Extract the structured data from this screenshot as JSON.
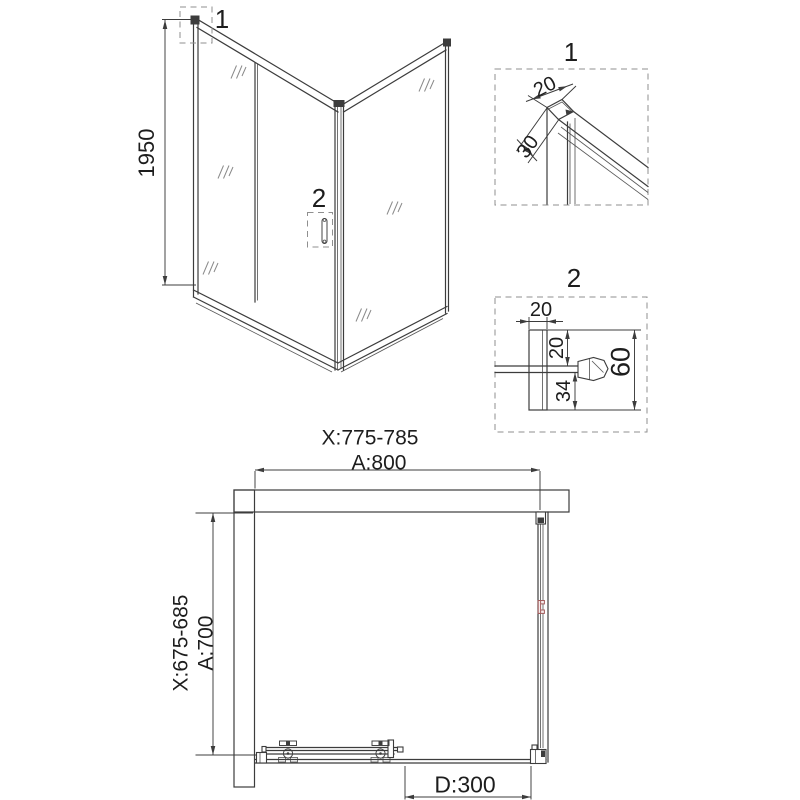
{
  "colors": {
    "line": "#3c3c3c",
    "accent_red": "#a25c5c",
    "text": "#1d1d1d"
  },
  "iso_view": {
    "height_dim": "1950",
    "callout_top": "1",
    "callout_handle": "2"
  },
  "detail_1": {
    "title": "1",
    "dim_width": "20",
    "dim_depth": "30"
  },
  "detail_2": {
    "title": "2",
    "dim_profile_width": "20",
    "dim_top": "20",
    "dim_bottom": "34",
    "dim_total": "60"
  },
  "plan_view": {
    "width_range": "X:775-785",
    "width": "A:800",
    "depth_range": "X:675-685",
    "depth": "A:700",
    "door_width": "D:300"
  }
}
